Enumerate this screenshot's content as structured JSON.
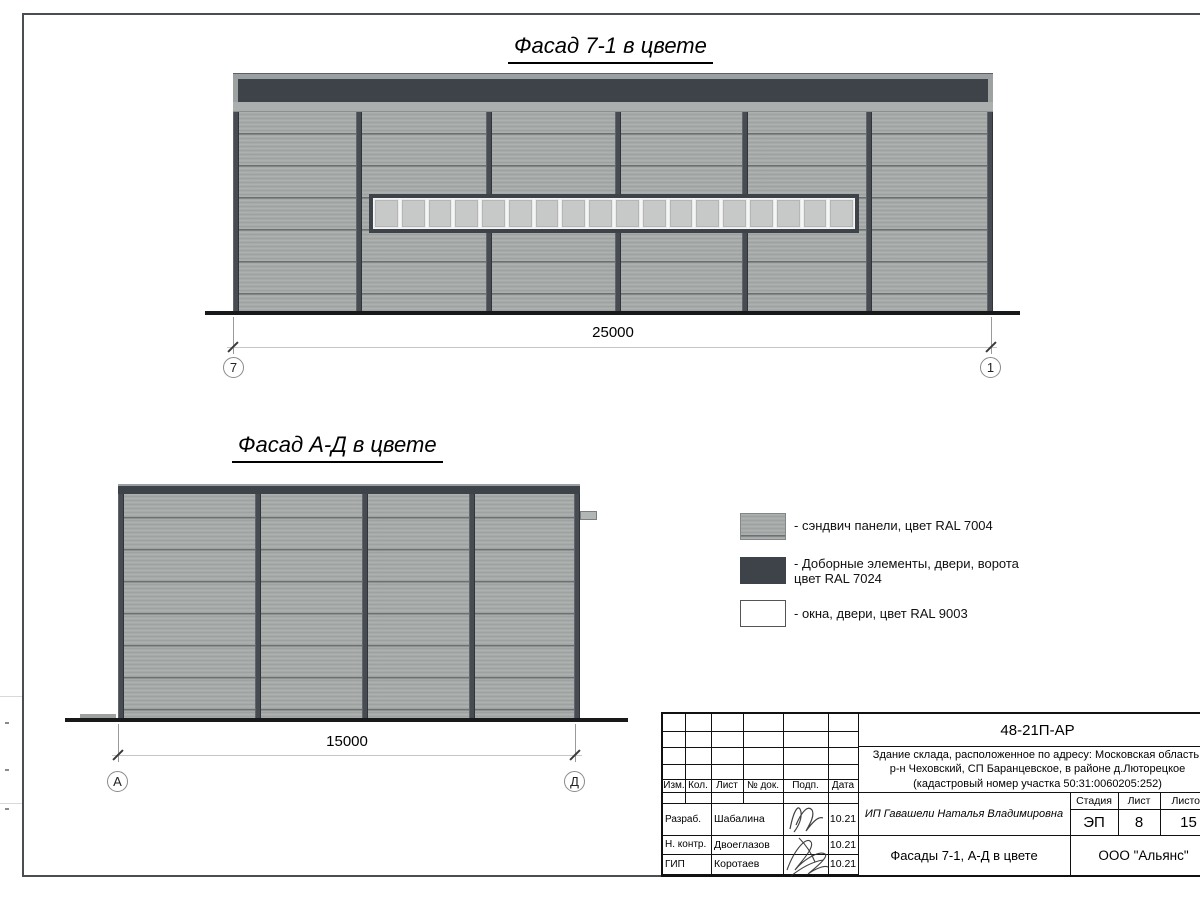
{
  "sheet": {
    "facade1_title": "Фасад 7-1 в цвете",
    "facade2_title": "Фасад А-Д в цвете"
  },
  "facade1": {
    "dimension_label": "25000",
    "axis_start": "7",
    "axis_end": "1",
    "window_pane_count": 18
  },
  "facade2": {
    "dimension_label": "15000",
    "axis_start": "А",
    "axis_end": "Д"
  },
  "legend": {
    "item1_label": "- сэндвич панели, цвет RAL 7004",
    "item2_label_line1": "- Доборные элементы, двери, ворота",
    "item2_label_line2": "цвет RAL 7024",
    "item3_label": "- окна, двери, цвет RAL 9003"
  },
  "colors": {
    "panel_ral_7004": "#a6aaa8",
    "dark_ral_7024": "#3e434a",
    "white_ral_9003": "#ffffff"
  },
  "title_block": {
    "code": "48-21П-АР",
    "description_line1": "Здание склада, расположенное по адресу: Московская область,",
    "description_line2": "р-н Чеховский, СП Баранцевское, в районе д.Люторецкое",
    "description_line3": "(кадастровый номер участка 50:31:0060205:252)",
    "col_izm": "Изм.",
    "col_kol": "Кол.",
    "col_list": "Лист",
    "col_doc": "№ док.",
    "col_podp": "Подп.",
    "col_data": "Дата",
    "stage_label": "Стадия",
    "sheet_label": "Лист",
    "sheets_label": "Листов",
    "stage_value": "ЭП",
    "sheet_value": "8",
    "sheets_value": "15",
    "client": "ИП Гавашели Наталья Владимировна",
    "doc_title": "Фасады 7-1, А-Д в цвете",
    "company": "ООО \"Альянс\"",
    "rows": [
      {
        "role": "Разраб.",
        "name": "Шабалина",
        "date": "10.21"
      },
      {
        "role": "Н. контр.",
        "name": "Двоеглазов",
        "date": "10.21"
      },
      {
        "role": "ГИП",
        "name": "Коротаев",
        "date": "10.21"
      }
    ]
  }
}
